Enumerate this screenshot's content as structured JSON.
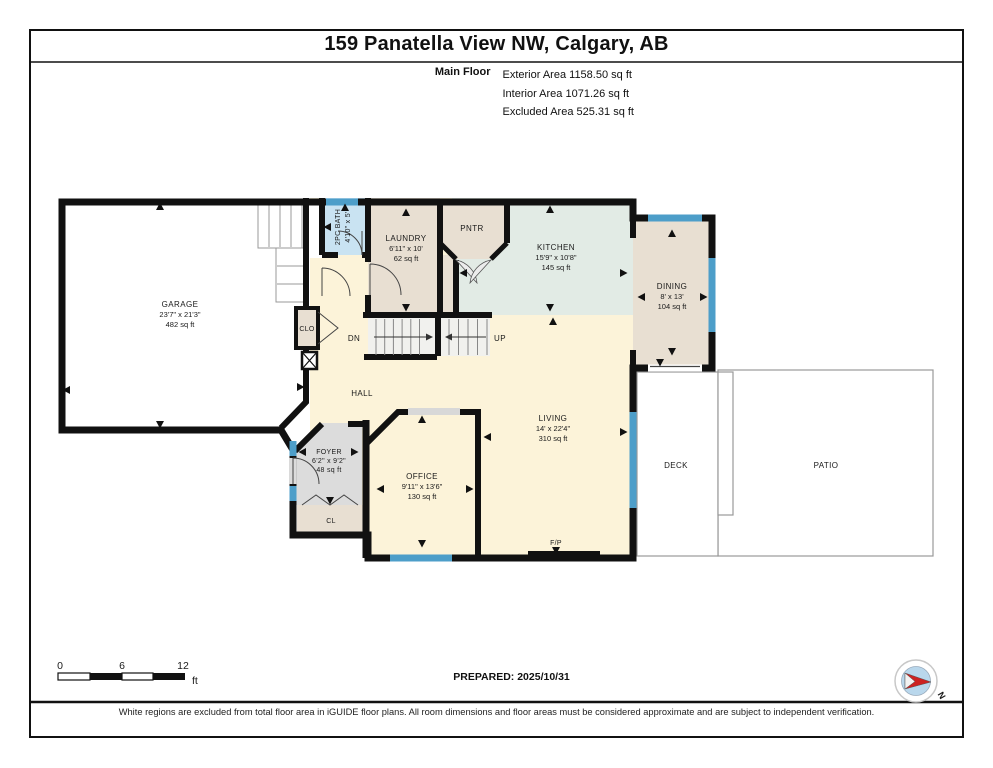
{
  "header": {
    "title": "159 Panatella View NW, Calgary, AB",
    "floor_label": "Main Floor",
    "area_lines": [
      "Exterior Area 1158.50 sq ft",
      "Interior Area 1071.26 sq ft",
      "Excluded Area 525.31 sq ft"
    ]
  },
  "rooms": {
    "garage": {
      "name": "GARAGE",
      "dims": "23'7\" x 21'3\"",
      "area": "482 sq ft"
    },
    "bath": {
      "name": "2PC BATH",
      "dims": "4'10\" x 5'"
    },
    "laundry": {
      "name": "LAUNDRY",
      "dims": "6'11\" x 10'",
      "area": "62 sq ft"
    },
    "pantry": {
      "name": "PNTR"
    },
    "kitchen": {
      "name": "KITCHEN",
      "dims": "15'9\" x 10'8\"",
      "area": "145 sq ft"
    },
    "dining": {
      "name": "DINING",
      "dims": "8' x 13'",
      "area": "104 sq ft"
    },
    "living": {
      "name": "LIVING",
      "dims": "14' x 22'4\"",
      "area": "310 sq ft"
    },
    "office": {
      "name": "OFFICE",
      "dims": "9'11\" x 13'6\"",
      "area": "130 sq ft"
    },
    "foyer": {
      "name": "FOYER",
      "dims": "6'2\" x 9'2\"",
      "area": "48 sq ft"
    },
    "hall": {
      "name": "HALL"
    },
    "clo": {
      "name": "CLO"
    },
    "cl": {
      "name": "CL"
    },
    "deck": {
      "name": "DECK"
    },
    "patio": {
      "name": "PATIO"
    },
    "fireplace": {
      "name": "F/P"
    },
    "stairs": {
      "down": "DN",
      "up": "UP"
    }
  },
  "scale_bar": {
    "ticks": [
      "0",
      "6",
      "12"
    ],
    "unit": "ft"
  },
  "footer": {
    "prepared": "PREPARED: 2025/10/31",
    "compass_n": "N",
    "disclaimer": "White regions are excluded from total floor area in iGUIDE floor plans. All room dimensions and floor areas must be considered approximate and are subject to independent verification."
  },
  "colors": {
    "wall": "#111111",
    "floor_cream": "#fcf3d9",
    "floor_tan": "#e8dfd2",
    "floor_mint": "#e2ebe5",
    "floor_blue": "#c9e3f2",
    "floor_gray": "#dcdcdc",
    "window_blue": "#4d9ec9",
    "excluded_white": "#ffffff",
    "compass_red": "#cc2222",
    "compass_blue": "#b9d7ec"
  }
}
